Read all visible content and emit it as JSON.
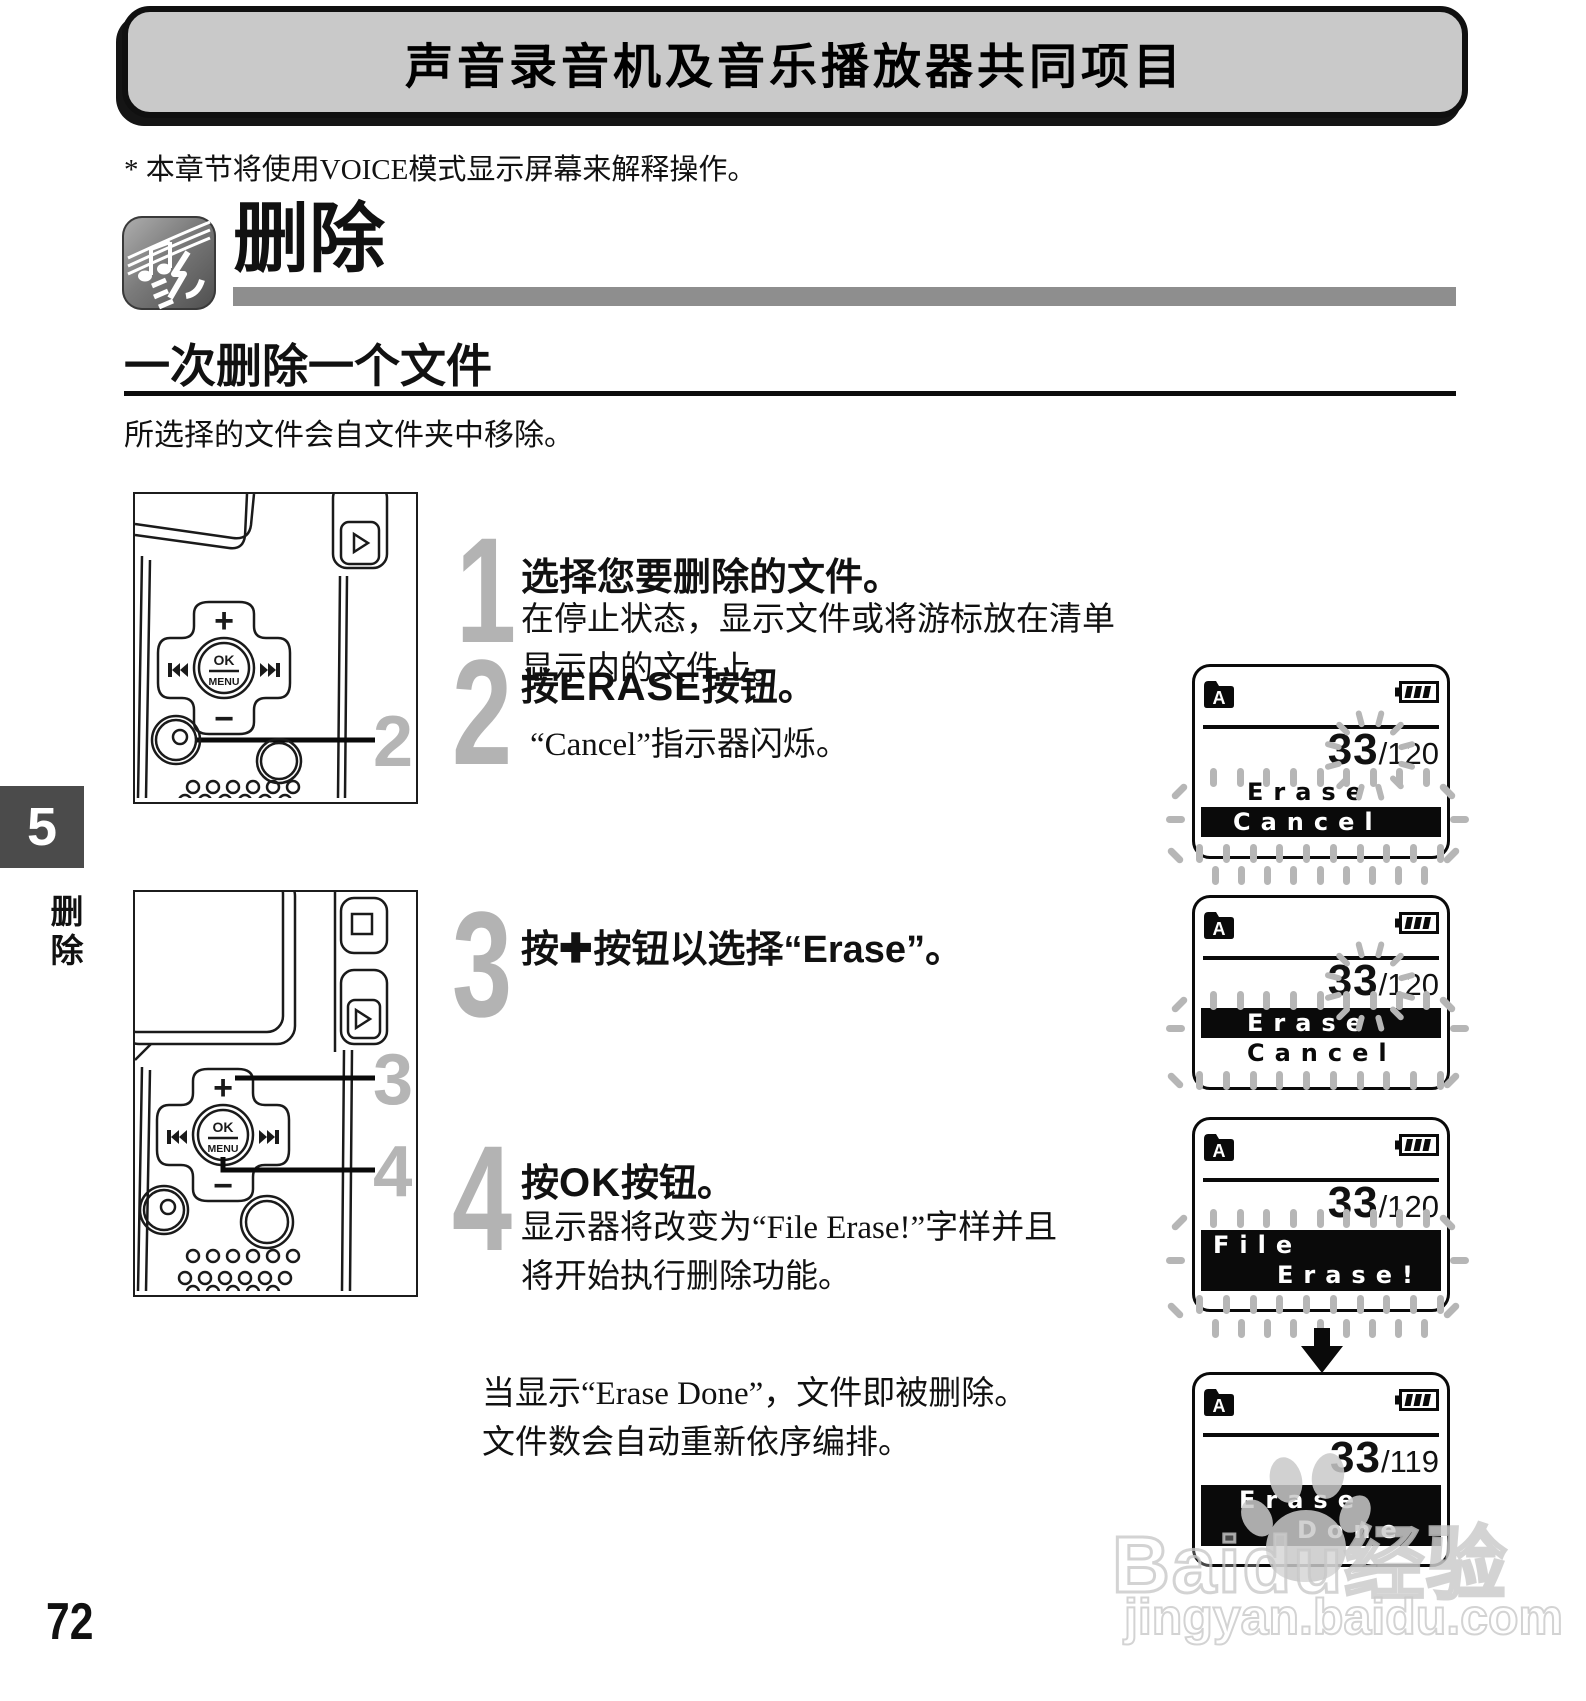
{
  "header": {
    "title": "声音录音机及音乐播放器共同项目"
  },
  "note": "* 本章节将使用VOICE模式显示屏幕来解释操作。",
  "section": {
    "title": "删除"
  },
  "subsection": {
    "title": "一次删除一个文件",
    "intro": "所选择的文件会自文件夹中移除。"
  },
  "sidebar": {
    "chapter": "5",
    "label": "删除"
  },
  "footer": {
    "page": "72"
  },
  "watermark": {
    "brand": "Baidu经验",
    "url": "jingyan.baidu.com"
  },
  "device": {
    "ok": "OK",
    "menu": "MENU",
    "plus": "+",
    "minus": "−"
  },
  "callouts": {
    "erase_button": "2",
    "plus_button": "3",
    "ok_button": "4"
  },
  "steps": [
    {
      "num": "1",
      "title": "选择您要删除的文件。",
      "body": [
        "在停止状态，显示文件或将游标放在清单",
        "显示内的文件上。"
      ]
    },
    {
      "num": "2",
      "pre": "按",
      "key": "ERASE",
      "post": "按钮。",
      "body": [
        "“Cancel”指示器闪烁。"
      ]
    },
    {
      "num": "3",
      "pre": "按",
      "key": "✚",
      "post": "按钮以选择“Erase”。",
      "body": []
    },
    {
      "num": "4",
      "pre": "按",
      "key": "OK",
      "post": "按钮。",
      "body": [
        "显示器将改变为“File Erase!”字样并且",
        "将开始执行删除功能。"
      ]
    }
  ],
  "closing": [
    "当显示“Erase Done”，文件即被删除。",
    "文件数会自动重新依序编排。"
  ],
  "screens": [
    {
      "folder": "A",
      "num": "33",
      "den": "/120",
      "line1": "Erase",
      "line2": "Cancel"
    },
    {
      "folder": "A",
      "num": "33",
      "den": "/120",
      "line1": "Erase",
      "line2": "Cancel"
    },
    {
      "folder": "A",
      "num": "33",
      "den": "/120",
      "line1": "File",
      "line2": "Erase!"
    },
    {
      "folder": "A",
      "num": "33",
      "den": "/119",
      "line1": "Erase",
      "line2": "Done"
    }
  ]
}
